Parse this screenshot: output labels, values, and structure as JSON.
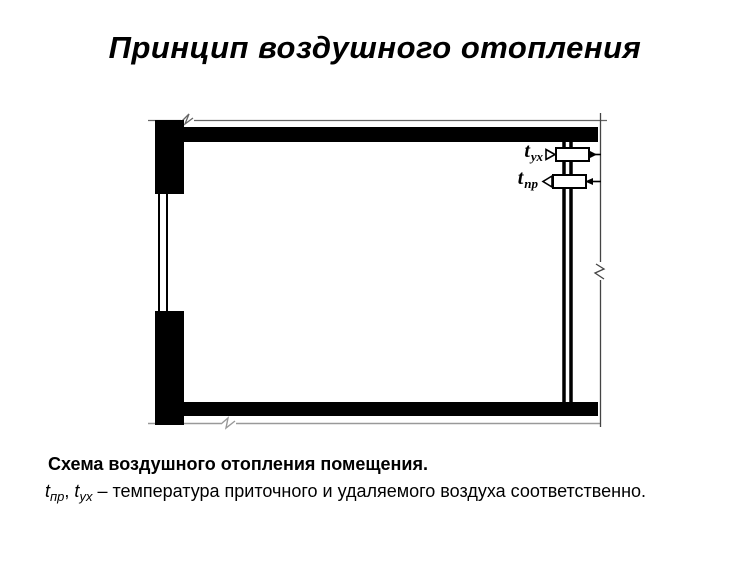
{
  "title": "Принцип воздушного отопления",
  "diagram": {
    "labels": {
      "exhaust": {
        "base": "t",
        "sub": "ух"
      },
      "supply": {
        "base": "t",
        "sub": "пр"
      }
    }
  },
  "caption": {
    "heading": "Схема воздушного отопления помещения.",
    "formula": {
      "supply_base": "t",
      "supply_sub": "пр",
      "separator": ", ",
      "exhaust_base": "t",
      "exhaust_sub": "ух",
      "rest": " – температура приточного и удаляемого воздуха соответственно."
    }
  },
  "colors": {
    "ink": "#000000",
    "background": "#ffffff",
    "reference_line": "#777777"
  }
}
